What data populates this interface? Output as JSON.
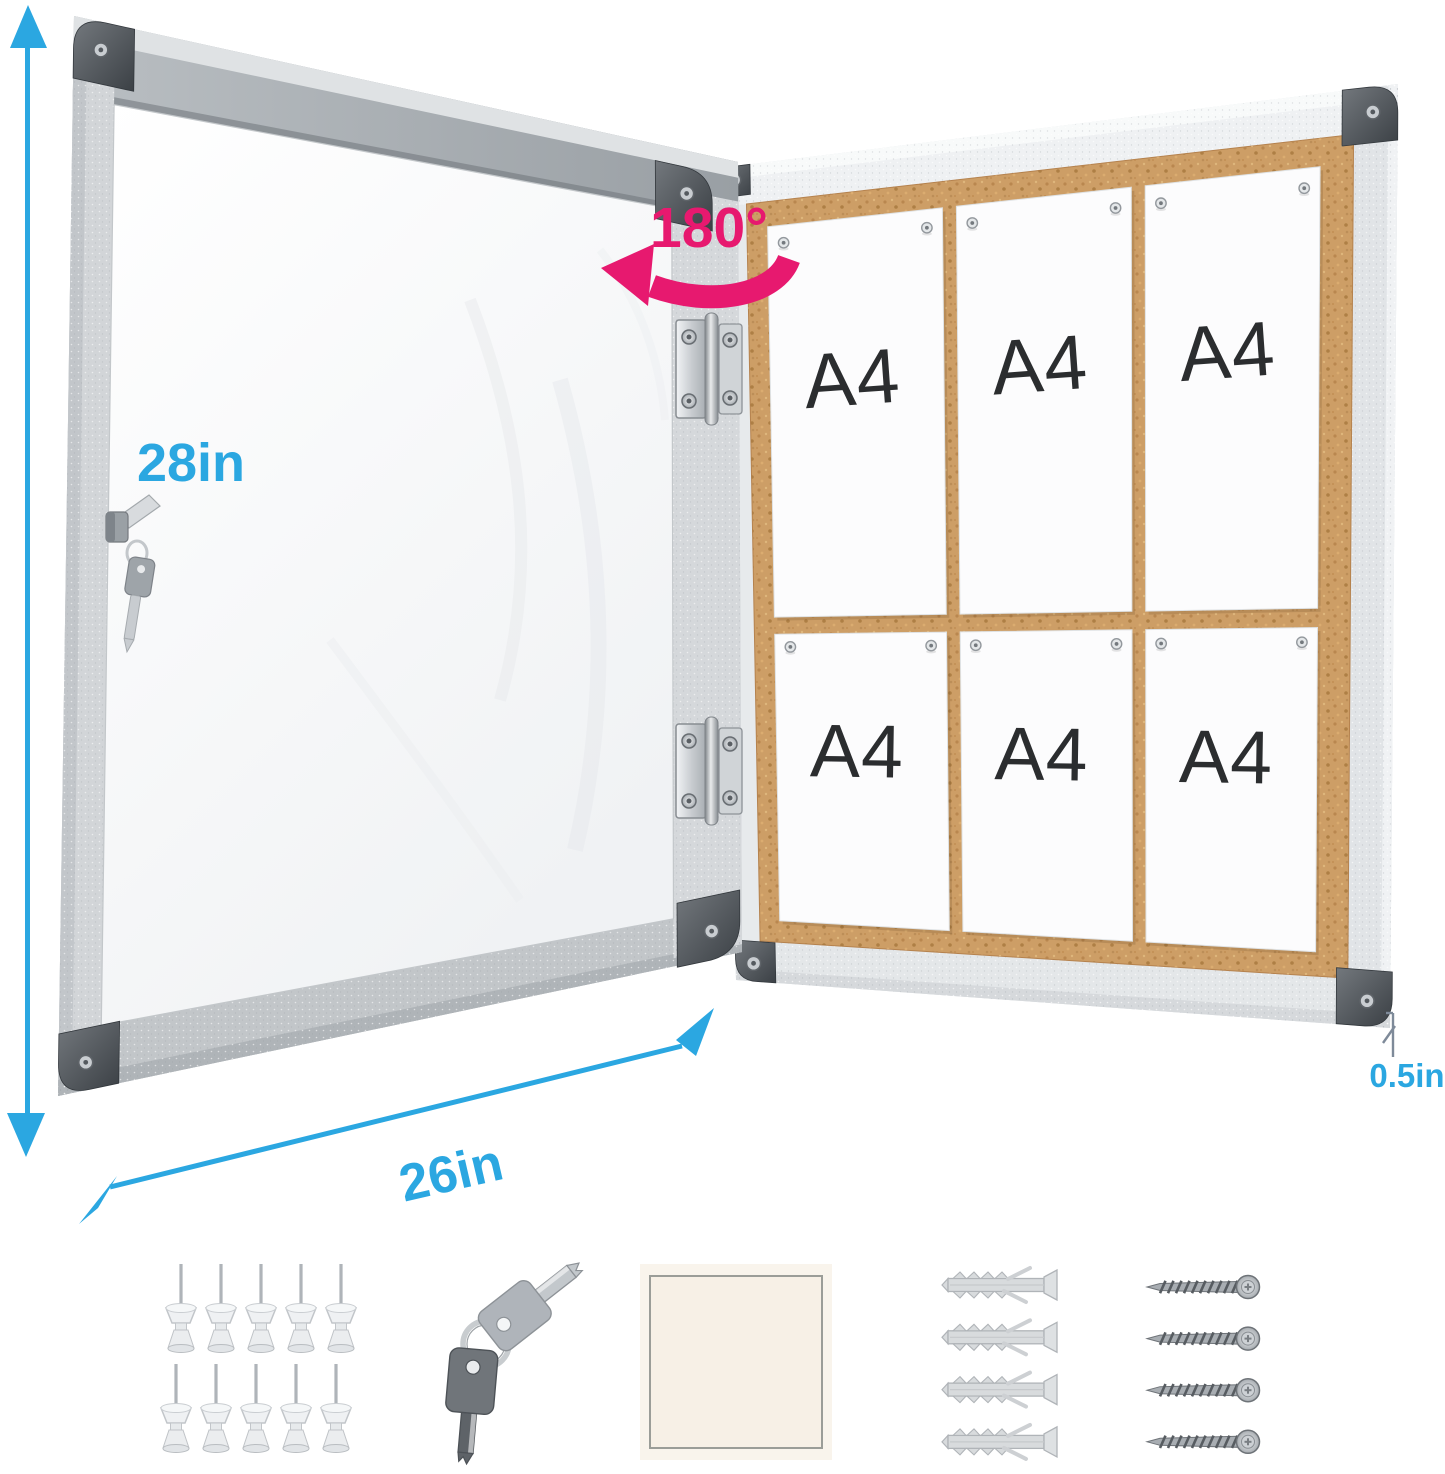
{
  "annotations": {
    "height": "28in",
    "width": "26in",
    "depth": "0.5in",
    "door_swing": "180°"
  },
  "board": {
    "rows": 2,
    "columns": 3,
    "sheets": [
      "A4",
      "A4",
      "A4",
      "A4",
      "A4",
      "A4"
    ]
  },
  "accessories": [
    {
      "name": "push-pins",
      "icon": "push-pin-icon",
      "count": 10
    },
    {
      "name": "keys",
      "icon": "key-icon",
      "count": 2
    },
    {
      "name": "adhesive-pad",
      "icon": "adhesive-pad-icon",
      "count": 1
    },
    {
      "name": "wall-anchors",
      "icon": "wall-anchor-icon",
      "count": 4
    },
    {
      "name": "screws",
      "icon": "screw-icon",
      "count": 4
    }
  ],
  "colors": {
    "dimension_blue": "#2BA7E1",
    "rotation_pink": "#E7196F",
    "cork": "#CD9E66",
    "frame_silver": "#D9DCDE",
    "cap_dark": "#44494E",
    "sheet_white": "#FCFCFD",
    "sheet_text": "#2B2D2F"
  }
}
